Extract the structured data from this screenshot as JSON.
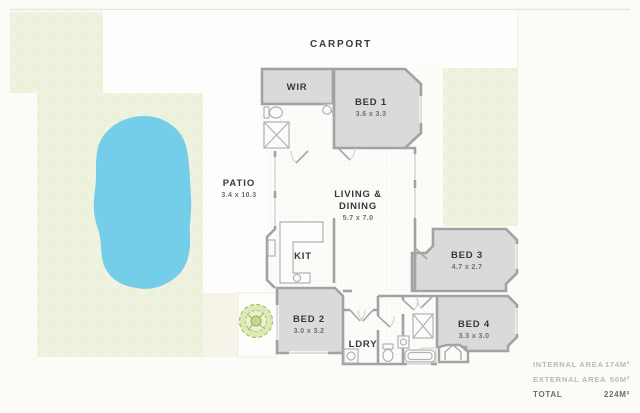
{
  "site": {
    "carport": {
      "label": "CARPORT"
    },
    "patio": {
      "label": "PATIO",
      "dims": "3.4 x 10.3"
    }
  },
  "rooms": {
    "wir": {
      "label": "WIR"
    },
    "bed1": {
      "label": "BED 1",
      "dims": "3.6 x 3.3"
    },
    "living": {
      "label_line1": "LIVING &",
      "label_line2": "DINING",
      "dims": "5.7 x 7.0"
    },
    "kit": {
      "label": "KIT"
    },
    "bed2": {
      "label": "BED 2",
      "dims": "3.0 x 3.2"
    },
    "ldry": {
      "label": "LDRY"
    },
    "bed3": {
      "label": "BED 3",
      "dims": "4.7 x 2.7"
    },
    "bed4": {
      "label": "BED 4",
      "dims": "3.3 x 3.0"
    }
  },
  "area_table": {
    "rows": [
      {
        "label": "INTERNAL AREA",
        "value": "174M²"
      },
      {
        "label": "EXTERNAL AREA",
        "value": "50M²"
      }
    ],
    "total": {
      "label": "TOTAL",
      "value": "224M²"
    }
  },
  "colors": {
    "pool": "#74cde9",
    "grass": "#f0f3e1",
    "room_fill": "#dadada",
    "wall": "#a2a2a2",
    "floor_white": "#fcfcfb"
  }
}
